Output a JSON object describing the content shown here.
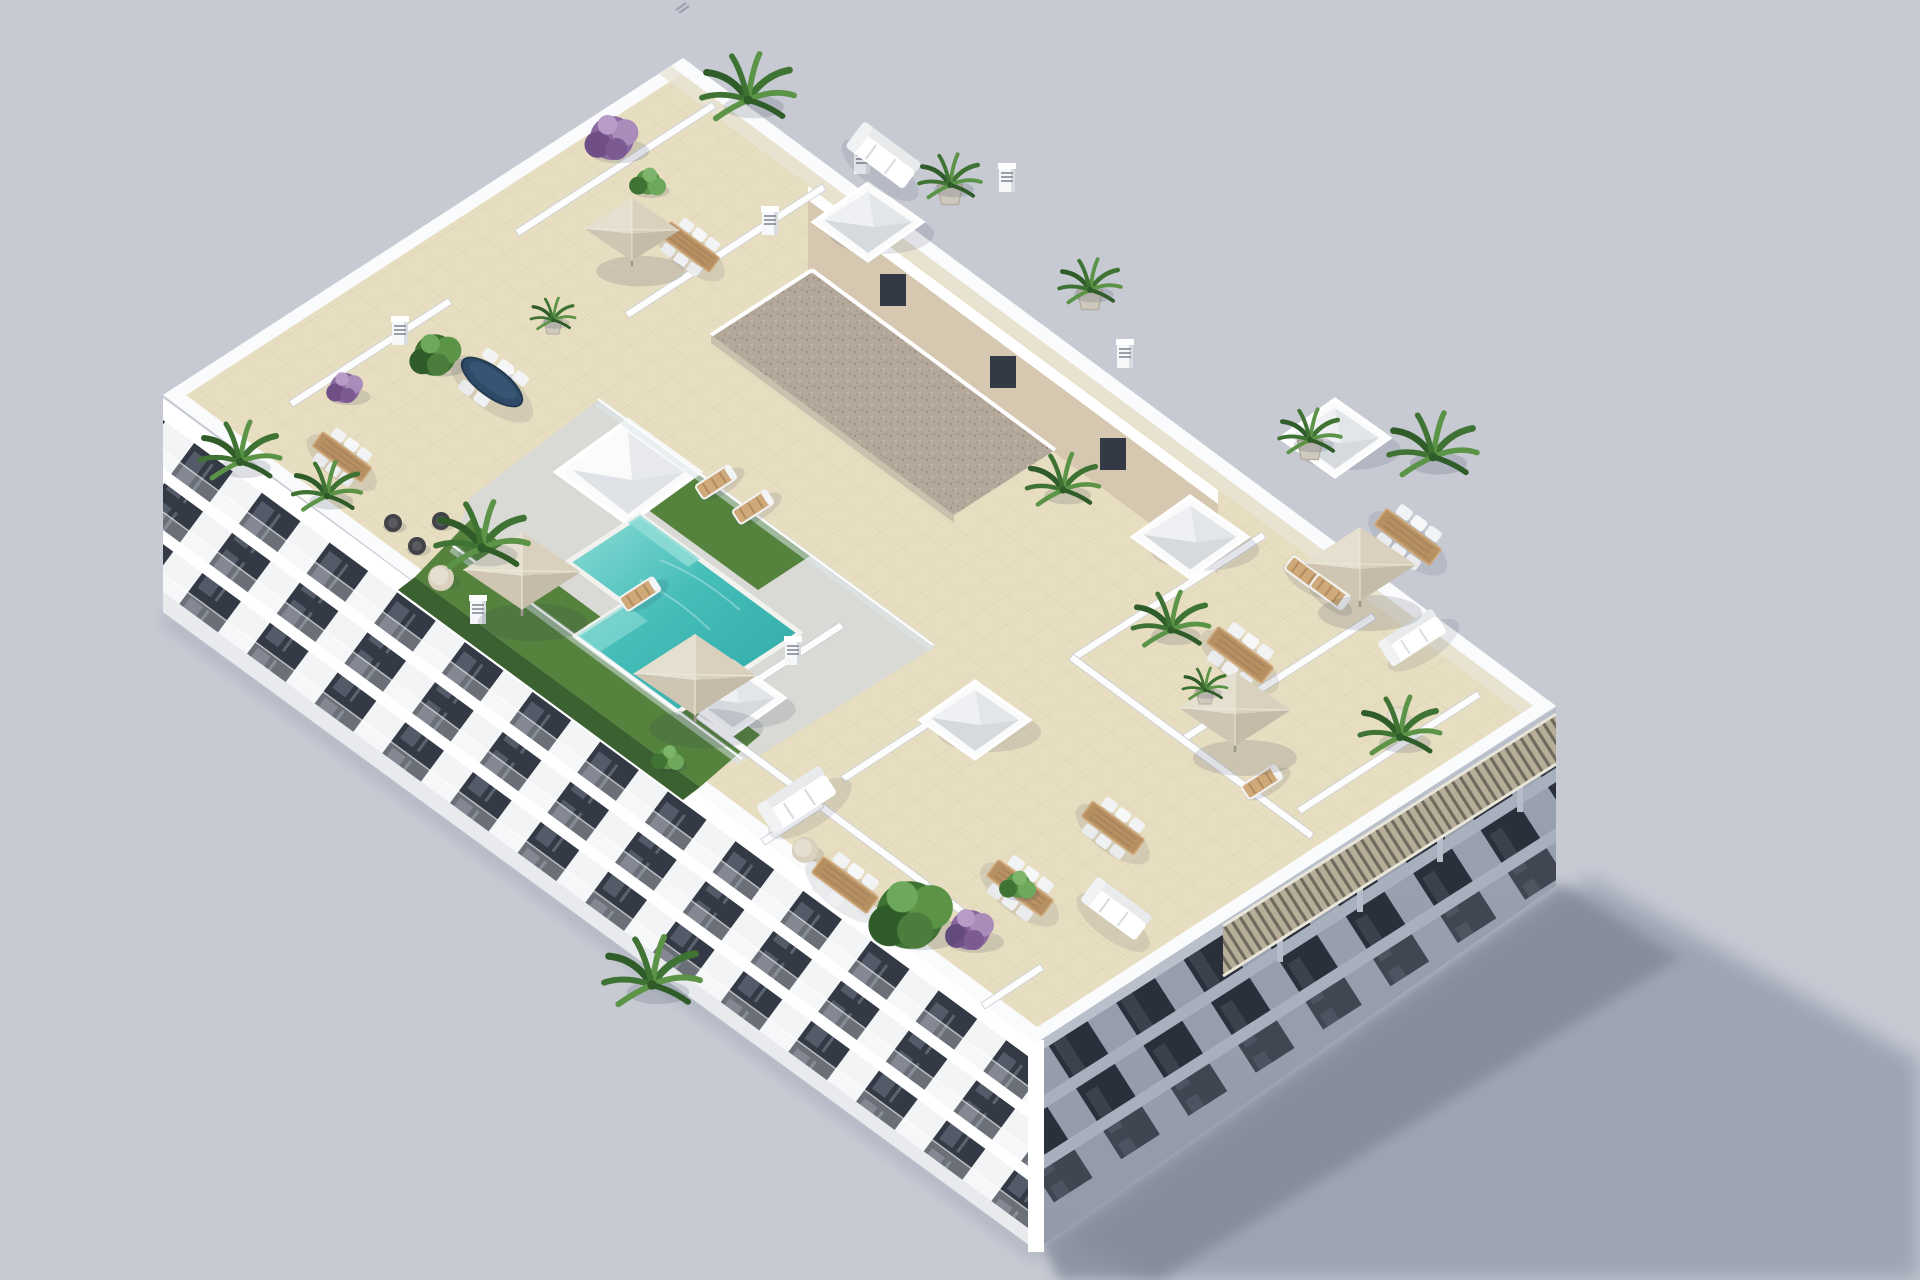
{
  "meta": {
    "description": "Aerial 3D architectural rendering of a white apartment building with a rooftop terrace: communal turquoise pool with glass fence and artificial grass, private tiled terraces separated by white walls, beige parasols, wooden dining sets with white chairs, white lounge sofas, sun loungers, potted palms and purple bougainvillea, a gravel-roofed stair core with pyramid skylights, a slatted wood pergola along the shaded edge, and a long shadow cast on a plain grey ground.",
    "view": "aerial three-quarter view from the south-west",
    "lighting": "sunlight from upper left, cast shadow toward lower right"
  },
  "canvas": {
    "width": 1920,
    "height": 1280
  },
  "colors": {
    "background": "#c7cad3",
    "shadow": "#99a0b1",
    "shadowDark": "#808898",
    "facadeLight": "#f3f4f6",
    "facadeShade": "#9aa2b1",
    "slab": "#ffffff",
    "slabShade": "#a9b0bd",
    "trimShade": "#b9c0cc",
    "baseShade": "#939baa",
    "windowDark": "#333a45",
    "windowShadeDark": "#2a303b",
    "parapet": "#fafbfc",
    "tile": "#e7ddc0",
    "tileLine": "#d3c6a4",
    "deck": "#d9dad5",
    "grass": "#55833d",
    "hedge": "#3c6130",
    "pool": "#45bdb9",
    "poolDeep": "#2fa9a6",
    "poolLight": "#8fdcd6",
    "gravel": "#b4a89b",
    "gravelDot": "#94887b",
    "tan": "#d5c7b0",
    "wood": "#b68f63",
    "woodLight": "#cfa97a",
    "canopy": "#d9d0bd",
    "canopyShade": "#c4bba8",
    "canopyLight": "#e5dfcf",
    "white": "#ffffff",
    "glass": "#dde6ea",
    "navy": "#2e4a66",
    "palm": "#3f7333",
    "palmDark": "#2f5c28",
    "leaf": "#5b9447",
    "purple": "#8a68a0",
    "purpleDark": "#6f4f86",
    "wicker": "#424347",
    "pergolaWood": "#b7ae99",
    "pergolaGap": "#6e6a5e"
  },
  "scene": {
    "ground": {
      "label": "plain grey studio ground",
      "cast_shadow": "building shadow to lower right"
    },
    "building": {
      "label": "white residential apartment block",
      "floors_below_roof": 3,
      "southwest_facade": "sunlit white facade with dark recessed windows and glass balconies",
      "southeast_facade": "shaded facade with balconies and slatted wood pergola strip",
      "stair_core": {
        "label": "rooftop stair/elevator core",
        "roof": "brown gravel flat roof",
        "windows": 3
      }
    },
    "rooftop": {
      "surface": "beige ceramic tile deck divided by white parapet walls",
      "pool": {
        "label": "communal swimming pool",
        "shape": "stepped L-shape",
        "water": "turquoise",
        "edge": "white coping",
        "fence": "glass balustrade"
      },
      "grass_areas": 2,
      "hedge_strips": 1,
      "pyramid_skylights": 5,
      "stair_skylight_wedge": 1,
      "parasols": 5,
      "wooden_dining_sets": 7,
      "navy_oval_dining_set": 1,
      "sofa_sets": 4,
      "wicker_lounge_chairs": 3,
      "sun_loungers": 6,
      "large_palms": 9,
      "potted_palms": 3,
      "purple_trees": 3,
      "green_trees_bushes": 5,
      "planter_pots": 2,
      "chimney_stacks": 8,
      "pergola": {
        "label": "slatted wood pergola along south-east roof edge"
      }
    }
  }
}
